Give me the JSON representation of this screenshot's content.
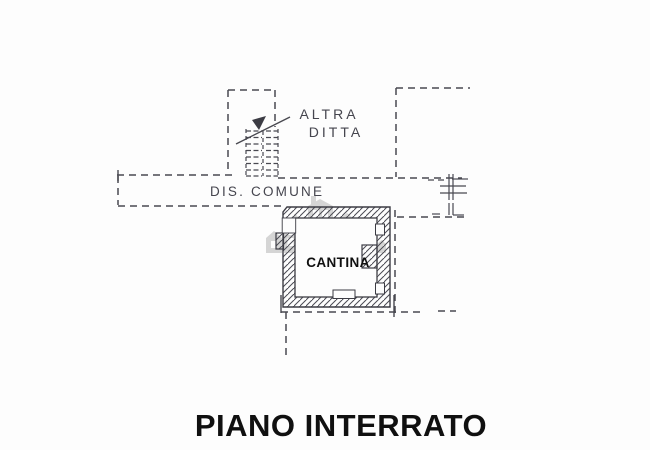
{
  "plan": {
    "title": "PIANO INTERRATO",
    "labels": {
      "altra_ditta_line1": "ALTRA",
      "altra_ditta_line2": "DITTA",
      "dis_comune": "DIS. COMUNE",
      "cantina": "CANTINA"
    },
    "icons": {
      "watermark": "buildings-watermark-icon",
      "stair_arrow": "stair-direction-arrow-icon"
    },
    "colors": {
      "ink": "#494951",
      "wall_hatch": "#4a4a52",
      "printed_text": "#101010",
      "watermark_gray": "#b5b5b5",
      "background": "#fdfdfd"
    }
  }
}
